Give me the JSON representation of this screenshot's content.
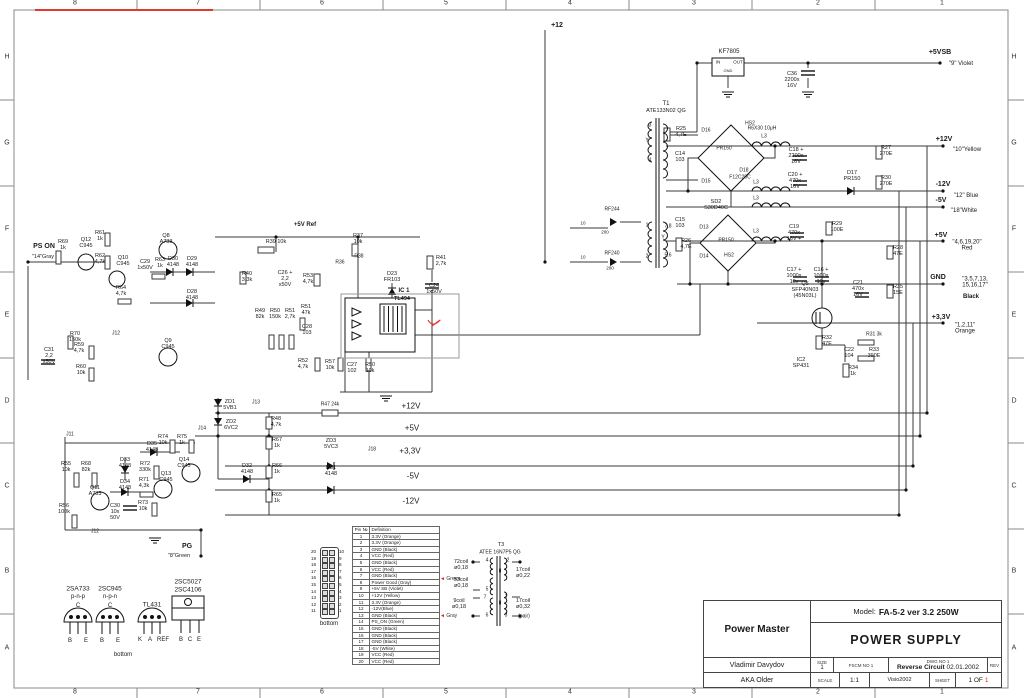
{
  "sheet": {
    "cols": [
      "8",
      "7",
      "6",
      "5",
      "4",
      "3",
      "2",
      "1"
    ],
    "rows": [
      "H",
      "G",
      "F",
      "E",
      "D",
      "C",
      "B",
      "A"
    ]
  },
  "title_block": {
    "company": "Power Master",
    "model_label": "Model:",
    "model": "FA-5-2 ver 3.2 250W",
    "title": "POWER SUPPLY",
    "author": "Vladimir Davydov",
    "alias": "AKA Older",
    "size_label": "SIZE",
    "size": "1",
    "fscm_label": "FSCM NO 1",
    "dwg_label": "DWG NO 1",
    "dwg": "Reverse Circuit",
    "dwg_date": "02.01.2002",
    "rev_label": "REV",
    "scale_label": "SCALE",
    "scale": "1:1",
    "tool": "Visio2002",
    "sheet_label": "SHEET",
    "sheet": "1 OF",
    "sheet_num": "1"
  },
  "pin_table": {
    "headers": [
      "Pin №",
      "Definition"
    ],
    "rows": [
      [
        "1",
        "3.3V (Orange)"
      ],
      [
        "2",
        "3.3V (Orange)"
      ],
      [
        "3",
        "GND (Black)"
      ],
      [
        "4",
        "VCC (Red)"
      ],
      [
        "5",
        "GND (Black)"
      ],
      [
        "6",
        "VCC (Red)"
      ],
      [
        "7",
        "GND (Black)"
      ],
      [
        "8",
        "Power Good (Gray)"
      ],
      [
        "9",
        "+5V SB (Violet)"
      ],
      [
        "10",
        "+12V (Yellow)"
      ],
      [
        "11",
        "3.3V (Orange)"
      ],
      [
        "12",
        "-12V(Blue)"
      ],
      [
        "13",
        "GND (Black)"
      ],
      [
        "14",
        "PS_ON (Green)"
      ],
      [
        "15",
        "GND (Black)"
      ],
      [
        "16",
        "GND (Black)"
      ],
      [
        "17",
        "GND (Black)"
      ],
      [
        "18",
        "-5V (White)"
      ],
      [
        "19",
        "VCC (Red)"
      ],
      [
        "20",
        "VCC (Red)"
      ]
    ],
    "annotations": [
      {
        "row": 8,
        "text": "Green"
      },
      {
        "row": 14,
        "text": "Gray"
      }
    ]
  },
  "connector": {
    "left": [
      "20",
      "19",
      "18",
      "17",
      "16",
      "15",
      "14",
      "13",
      "12",
      "11"
    ],
    "right": [
      "10",
      "9",
      "8",
      "7",
      "6",
      "5",
      "4",
      "3",
      "2",
      "1"
    ],
    "caption": "bottom"
  },
  "colors": {
    "wire": "#3a3a3a",
    "accent_red": "#e03a2f",
    "label": "#1a1a1a"
  },
  "labels": [
    {
      "t": "+12",
      "x": 557,
      "y": 26,
      "s": 7,
      "b": 1
    },
    {
      "t": "KF7805",
      "x": 729,
      "y": 52,
      "s": 6
    },
    {
      "t": "IN",
      "x": 718,
      "y": 63,
      "s": 4.5
    },
    {
      "t": "OUT",
      "x": 738,
      "y": 63,
      "s": 4.5
    },
    {
      "t": "GND",
      "x": 728,
      "y": 71,
      "s": 4
    },
    {
      "t": "C36\n2200x\n16V",
      "x": 792,
      "y": 81
    },
    {
      "t": "+5VSB",
      "x": 940,
      "y": 53,
      "b": 1,
      "s": 7
    },
    {
      "t": "\"9\" Violet",
      "x": 961,
      "y": 64,
      "s": 6
    },
    {
      "t": "T1",
      "x": 666,
      "y": 104,
      "s": 6
    },
    {
      "t": "ATE133N02 QG",
      "x": 666,
      "y": 112,
      "s": 5.5
    },
    {
      "t": "R25\n4,7E",
      "x": 681,
      "y": 133
    },
    {
      "t": "D16",
      "x": 706,
      "y": 131,
      "s": 5
    },
    {
      "t": "HS2",
      "x": 750,
      "y": 124,
      "s": 5
    },
    {
      "t": "PR150",
      "x": 724,
      "y": 149,
      "s": 5
    },
    {
      "t": "D15",
      "x": 706,
      "y": 182,
      "s": 5
    },
    {
      "t": "D18",
      "x": 744,
      "y": 171,
      "s": 5
    },
    {
      "t": "F12C20C",
      "x": 740,
      "y": 178,
      "s": 5
    },
    {
      "t": "R6X30 10μH",
      "x": 762,
      "y": 129,
      "s": 5
    },
    {
      "t": "L3",
      "x": 764,
      "y": 137,
      "s": 5
    },
    {
      "t": "C14\n103",
      "x": 680,
      "y": 158
    },
    {
      "t": "3",
      "x": 650,
      "y": 126,
      "s": 5
    },
    {
      "t": "Y",
      "x": 647,
      "y": 141,
      "s": 5
    },
    {
      "t": "4",
      "x": 650,
      "y": 161,
      "s": 5
    },
    {
      "t": "C18 +\n2200x\n16V",
      "x": 796,
      "y": 157
    },
    {
      "t": "R27\n270E",
      "x": 886,
      "y": 152
    },
    {
      "t": "C20 +\n470x\n16V",
      "x": 795,
      "y": 182
    },
    {
      "t": "D17\nPR150",
      "x": 852,
      "y": 177
    },
    {
      "t": "R30\n270E",
      "x": 886,
      "y": 182
    },
    {
      "t": "+12V",
      "x": 944,
      "y": 140,
      "b": 1,
      "s": 7
    },
    {
      "t": "\"10\"Yellow",
      "x": 967,
      "y": 150,
      "s": 6
    },
    {
      "t": "-12V",
      "x": 943,
      "y": 185,
      "b": 1,
      "s": 7
    },
    {
      "t": "\"12\" Blue",
      "x": 966,
      "y": 196,
      "s": 6
    },
    {
      "t": "-5V",
      "x": 941,
      "y": 201,
      "b": 1,
      "s": 7
    },
    {
      "t": "\"18\"White",
      "x": 964,
      "y": 211,
      "s": 6
    },
    {
      "t": "L3",
      "x": 756,
      "y": 183,
      "s": 5
    },
    {
      "t": "L3",
      "x": 756,
      "y": 199,
      "s": 5
    },
    {
      "t": "L3",
      "x": 756,
      "y": 232,
      "s": 5
    },
    {
      "t": "SD2\nS30D40C",
      "x": 716,
      "y": 206
    },
    {
      "t": "C15\n103",
      "x": 680,
      "y": 224
    },
    {
      "t": "D13",
      "x": 704,
      "y": 228,
      "s": 5
    },
    {
      "t": "PR150",
      "x": 726,
      "y": 241,
      "s": 5
    },
    {
      "t": "D14",
      "x": 704,
      "y": 257,
      "s": 5
    },
    {
      "t": "HS2",
      "x": 729,
      "y": 256,
      "s": 5
    },
    {
      "t": "R26\n4,7E",
      "x": 686,
      "y": 245
    },
    {
      "t": "7,8",
      "x": 668,
      "y": 227,
      "s": 5
    },
    {
      "t": "Y",
      "x": 663,
      "y": 238,
      "s": 5
    },
    {
      "t": "5,6",
      "x": 668,
      "y": 256,
      "s": 5
    },
    {
      "t": "1",
      "x": 647,
      "y": 226,
      "s": 5
    },
    {
      "t": "2",
      "x": 647,
      "y": 257,
      "s": 5
    },
    {
      "t": "RF244",
      "x": 612,
      "y": 210,
      "s": 5
    },
    {
      "t": "RF240",
      "x": 612,
      "y": 254,
      "s": 5
    },
    {
      "t": "10",
      "x": 583,
      "y": 224,
      "s": 4.5
    },
    {
      "t": "200",
      "x": 605,
      "y": 233,
      "s": 4.5
    },
    {
      "t": "10",
      "x": 583,
      "y": 258,
      "s": 4.5
    },
    {
      "t": "200",
      "x": 610,
      "y": 269,
      "s": 4.5
    },
    {
      "t": "+5V",
      "x": 941,
      "y": 236,
      "b": 1,
      "s": 7
    },
    {
      "t": "\"4,6,19,20\"\nRed",
      "x": 967,
      "y": 246,
      "s": 6
    },
    {
      "t": "C19\n470x\n16V +",
      "x": 794,
      "y": 234
    },
    {
      "t": "R29\n100E",
      "x": 837,
      "y": 228
    },
    {
      "t": "R28\n47E",
      "x": 898,
      "y": 252
    },
    {
      "t": "C17 +\n1000x\n10v",
      "x": 794,
      "y": 277
    },
    {
      "t": "C16 +\n1000x\n10v",
      "x": 821,
      "y": 277
    },
    {
      "t": "GND",
      "x": 938,
      "y": 278,
      "b": 1,
      "s": 7
    },
    {
      "t": "\"3,5,7,13,\n15,16,17\"",
      "x": 975,
      "y": 283,
      "s": 6
    },
    {
      "t": "Black",
      "x": 971,
      "y": 297,
      "s": 6,
      "b": 1
    },
    {
      "t": "R35\n15E",
      "x": 898,
      "y": 291
    },
    {
      "t": "Q5\nSFP40N03\n(45N03L)",
      "x": 805,
      "y": 291
    },
    {
      "t": "C21\n470x\n16V",
      "x": 858,
      "y": 290
    },
    {
      "t": "+3,3V",
      "x": 941,
      "y": 318,
      "b": 1,
      "s": 7
    },
    {
      "t": "\"1,2,11\"\nOrange",
      "x": 965,
      "y": 329,
      "s": 6
    },
    {
      "t": "R32\n47E",
      "x": 827,
      "y": 342
    },
    {
      "t": "R31 3k",
      "x": 874,
      "y": 335,
      "s": 5
    },
    {
      "t": "C22\n104",
      "x": 849,
      "y": 354
    },
    {
      "t": "R33\n390E",
      "x": 874,
      "y": 354
    },
    {
      "t": "IC2\nSP431",
      "x": 801,
      "y": 364
    },
    {
      "t": "R34\n1k",
      "x": 853,
      "y": 372
    },
    {
      "t": "PS ON",
      "x": 44,
      "y": 247,
      "b": 1,
      "s": 7
    },
    {
      "t": "\"14\"Gray",
      "x": 43,
      "y": 258,
      "s": 5.5
    },
    {
      "t": "R69\n1k",
      "x": 63,
      "y": 246
    },
    {
      "t": "Q12\nC945",
      "x": 86,
      "y": 244
    },
    {
      "t": "R61\n1k",
      "x": 100,
      "y": 237
    },
    {
      "t": "R62\n4,7k",
      "x": 100,
      "y": 260
    },
    {
      "t": "Q10\nC945",
      "x": 123,
      "y": 262
    },
    {
      "t": "C29\n1x50V",
      "x": 145,
      "y": 266
    },
    {
      "t": "R63\n1k",
      "x": 160,
      "y": 264
    },
    {
      "t": "D30\n4148",
      "x": 173,
      "y": 263
    },
    {
      "t": "D29\n4148",
      "x": 192,
      "y": 263
    },
    {
      "t": "Q8\nA733",
      "x": 166,
      "y": 240
    },
    {
      "t": "R64\n4,7k",
      "x": 121,
      "y": 292
    },
    {
      "t": "D28\n4148",
      "x": 192,
      "y": 296
    },
    {
      "t": "R70\n150k",
      "x": 75,
      "y": 338
    },
    {
      "t": "J12",
      "x": 116,
      "y": 334,
      "s": 5
    },
    {
      "t": "R59\n4,7k",
      "x": 79,
      "y": 349
    },
    {
      "t": "Q9\nC945",
      "x": 168,
      "y": 345
    },
    {
      "t": "C31\n2,2\nx50V",
      "x": 49,
      "y": 357
    },
    {
      "t": "R60\n10k",
      "x": 81,
      "y": 371
    },
    {
      "t": "+5V Ref",
      "x": 305,
      "y": 225,
      "b": 1,
      "s": 6
    },
    {
      "t": "R39  10k",
      "x": 276,
      "y": 243,
      "s": 5.5
    },
    {
      "t": "R37\n10k",
      "x": 358,
      "y": 240
    },
    {
      "t": "R38",
      "x": 359,
      "y": 257,
      "s": 5
    },
    {
      "t": "R36",
      "x": 340,
      "y": 263,
      "s": 5
    },
    {
      "t": "R40\n3,3k",
      "x": 247,
      "y": 278
    },
    {
      "t": "C26 +\n2,2\nx50V",
      "x": 285,
      "y": 280
    },
    {
      "t": "R53\n4,7k",
      "x": 308,
      "y": 280
    },
    {
      "t": "R49\n82k",
      "x": 260,
      "y": 315
    },
    {
      "t": "R50\n150k",
      "x": 275,
      "y": 315
    },
    {
      "t": "R51\n2,7k",
      "x": 290,
      "y": 315
    },
    {
      "t": "R51\n47k",
      "x": 306,
      "y": 311
    },
    {
      "t": "C28\n103",
      "x": 307,
      "y": 331
    },
    {
      "t": "R52\n4,7k",
      "x": 303,
      "y": 365
    },
    {
      "t": "R57\n10k",
      "x": 330,
      "y": 366
    },
    {
      "t": "C27\n102",
      "x": 352,
      "y": 369
    },
    {
      "t": "R50\n10k",
      "x": 370,
      "y": 369
    },
    {
      "t": "D23\nFR103",
      "x": 392,
      "y": 278
    },
    {
      "t": "IC 1",
      "x": 404,
      "y": 291,
      "b": 1,
      "s": 6
    },
    {
      "t": "TL494",
      "x": 402,
      "y": 300,
      "s": 5.5,
      "b": 1
    },
    {
      "t": "C24\n1x50V",
      "x": 434,
      "y": 290
    },
    {
      "t": "R41\n2,7k",
      "x": 441,
      "y": 262
    },
    {
      "t": "ZD1\n5VB1",
      "x": 230,
      "y": 406
    },
    {
      "t": "J13",
      "x": 256,
      "y": 403,
      "s": 5
    },
    {
      "t": "R47 24k",
      "x": 330,
      "y": 405,
      "s": 5
    },
    {
      "t": "+12V",
      "x": 411,
      "y": 407,
      "s": 8
    },
    {
      "t": "ZD2\n6VC2",
      "x": 231,
      "y": 426
    },
    {
      "t": "J14",
      "x": 202,
      "y": 429,
      "s": 5
    },
    {
      "t": "R48\n4,7k",
      "x": 276,
      "y": 423
    },
    {
      "t": "+5V",
      "x": 412,
      "y": 429,
      "s": 8
    },
    {
      "t": "R67\n1k",
      "x": 277,
      "y": 444
    },
    {
      "t": "ZD3\n5VC3",
      "x": 331,
      "y": 445
    },
    {
      "t": "J18",
      "x": 372,
      "y": 450,
      "s": 5
    },
    {
      "t": "+3,3V",
      "x": 410,
      "y": 452,
      "s": 8
    },
    {
      "t": "D32\n4148",
      "x": 247,
      "y": 470
    },
    {
      "t": "R66\n1k",
      "x": 277,
      "y": 470
    },
    {
      "t": "D31\n4148",
      "x": 331,
      "y": 472
    },
    {
      "t": "-5V",
      "x": 413,
      "y": 477,
      "s": 8
    },
    {
      "t": "R65\n1k",
      "x": 277,
      "y": 499
    },
    {
      "t": "-12V",
      "x": 411,
      "y": 502,
      "s": 8
    },
    {
      "t": "J11",
      "x": 70,
      "y": 435,
      "s": 5
    },
    {
      "t": "R55\n10k",
      "x": 66,
      "y": 468
    },
    {
      "t": "R68\n82k",
      "x": 86,
      "y": 468
    },
    {
      "t": "D33\n4148",
      "x": 125,
      "y": 464
    },
    {
      "t": "D34\n4148",
      "x": 125,
      "y": 486
    },
    {
      "t": "Q11\nA733",
      "x": 95,
      "y": 492
    },
    {
      "t": "R56\n100k",
      "x": 64,
      "y": 510
    },
    {
      "t": "C30\n10x\n50V",
      "x": 115,
      "y": 513
    },
    {
      "t": "R71\n4,3k",
      "x": 144,
      "y": 484
    },
    {
      "t": "R72\n330k",
      "x": 145,
      "y": 468
    },
    {
      "t": "D35\n4148",
      "x": 152,
      "y": 448
    },
    {
      "t": "R74\n10k",
      "x": 163,
      "y": 441
    },
    {
      "t": "R75\n1k",
      "x": 182,
      "y": 441
    },
    {
      "t": "Q13\nC945",
      "x": 166,
      "y": 478
    },
    {
      "t": "Q14\nC945",
      "x": 184,
      "y": 464
    },
    {
      "t": "R73\n10k",
      "x": 143,
      "y": 507
    },
    {
      "t": "J12",
      "x": 95,
      "y": 532,
      "s": 5
    },
    {
      "t": "PG",
      "x": 187,
      "y": 547,
      "b": 1,
      "s": 7
    },
    {
      "t": "\"8\"Green",
      "x": 179,
      "y": 557,
      "s": 5.5
    },
    {
      "t": "2SA733",
      "x": 78,
      "y": 589,
      "s": 6.5
    },
    {
      "t": "2SC945",
      "x": 110,
      "y": 589,
      "s": 6.5
    },
    {
      "t": "p-n-p",
      "x": 78,
      "y": 597,
      "s": 6
    },
    {
      "t": "n-p-n",
      "x": 110,
      "y": 597,
      "s": 6
    },
    {
      "t": "C",
      "x": 78,
      "y": 606,
      "s": 6
    },
    {
      "t": "C",
      "x": 110,
      "y": 606,
      "s": 6
    },
    {
      "t": "B",
      "x": 70,
      "y": 641,
      "s": 6
    },
    {
      "t": "E",
      "x": 86,
      "y": 641,
      "s": 6
    },
    {
      "t": "B",
      "x": 102,
      "y": 641,
      "s": 6
    },
    {
      "t": "E",
      "x": 118,
      "y": 641,
      "s": 6
    },
    {
      "t": "TL431",
      "x": 152,
      "y": 605,
      "s": 6.5
    },
    {
      "t": "K",
      "x": 140,
      "y": 640,
      "s": 6
    },
    {
      "t": "A",
      "x": 150,
      "y": 640,
      "s": 6
    },
    {
      "t": "REF",
      "x": 163,
      "y": 640,
      "s": 6
    },
    {
      "t": "2SC5027",
      "x": 188,
      "y": 582,
      "s": 6.5
    },
    {
      "t": "2SC4106",
      "x": 188,
      "y": 590,
      "s": 6.5
    },
    {
      "t": "B",
      "x": 181,
      "y": 640,
      "s": 6
    },
    {
      "t": "C",
      "x": 190,
      "y": 640,
      "s": 6
    },
    {
      "t": "E",
      "x": 199,
      "y": 640,
      "s": 6
    },
    {
      "t": "bottom",
      "x": 123,
      "y": 655,
      "s": 6
    },
    {
      "t": "T3",
      "x": 501,
      "y": 546,
      "s": 5.5
    },
    {
      "t": "ATEE 16N7P5 QG",
      "x": 500,
      "y": 553,
      "s": 5
    },
    {
      "t": "72coil\nø0,18",
      "x": 461,
      "y": 566
    },
    {
      "t": "53coil\nø0,18",
      "x": 461,
      "y": 584
    },
    {
      "t": "9coil\nø0,18",
      "x": 459,
      "y": 605
    },
    {
      "t": "4",
      "x": 487,
      "y": 561,
      "s": 5
    },
    {
      "t": "5",
      "x": 487,
      "y": 590,
      "s": 5
    },
    {
      "t": "7",
      "x": 485,
      "y": 598,
      "s": 5
    },
    {
      "t": "6",
      "x": 487,
      "y": 616,
      "s": 5
    },
    {
      "t": "2",
      "x": 508,
      "y": 561,
      "s": 5
    },
    {
      "t": "1",
      "x": 506,
      "y": 597,
      "s": 5
    },
    {
      "t": "3",
      "x": 506,
      "y": 616,
      "s": 5
    },
    {
      "t": "II",
      "x": 500,
      "y": 572,
      "s": 5
    },
    {
      "t": "II",
      "x": 500,
      "y": 604,
      "s": 5
    },
    {
      "t": "17coil\nø0,22",
      "x": 523,
      "y": 574
    },
    {
      "t": "17coil\nø0,32",
      "x": 523,
      "y": 605
    },
    {
      "t": "(pair)",
      "x": 524,
      "y": 617,
      "s": 5
    }
  ]
}
